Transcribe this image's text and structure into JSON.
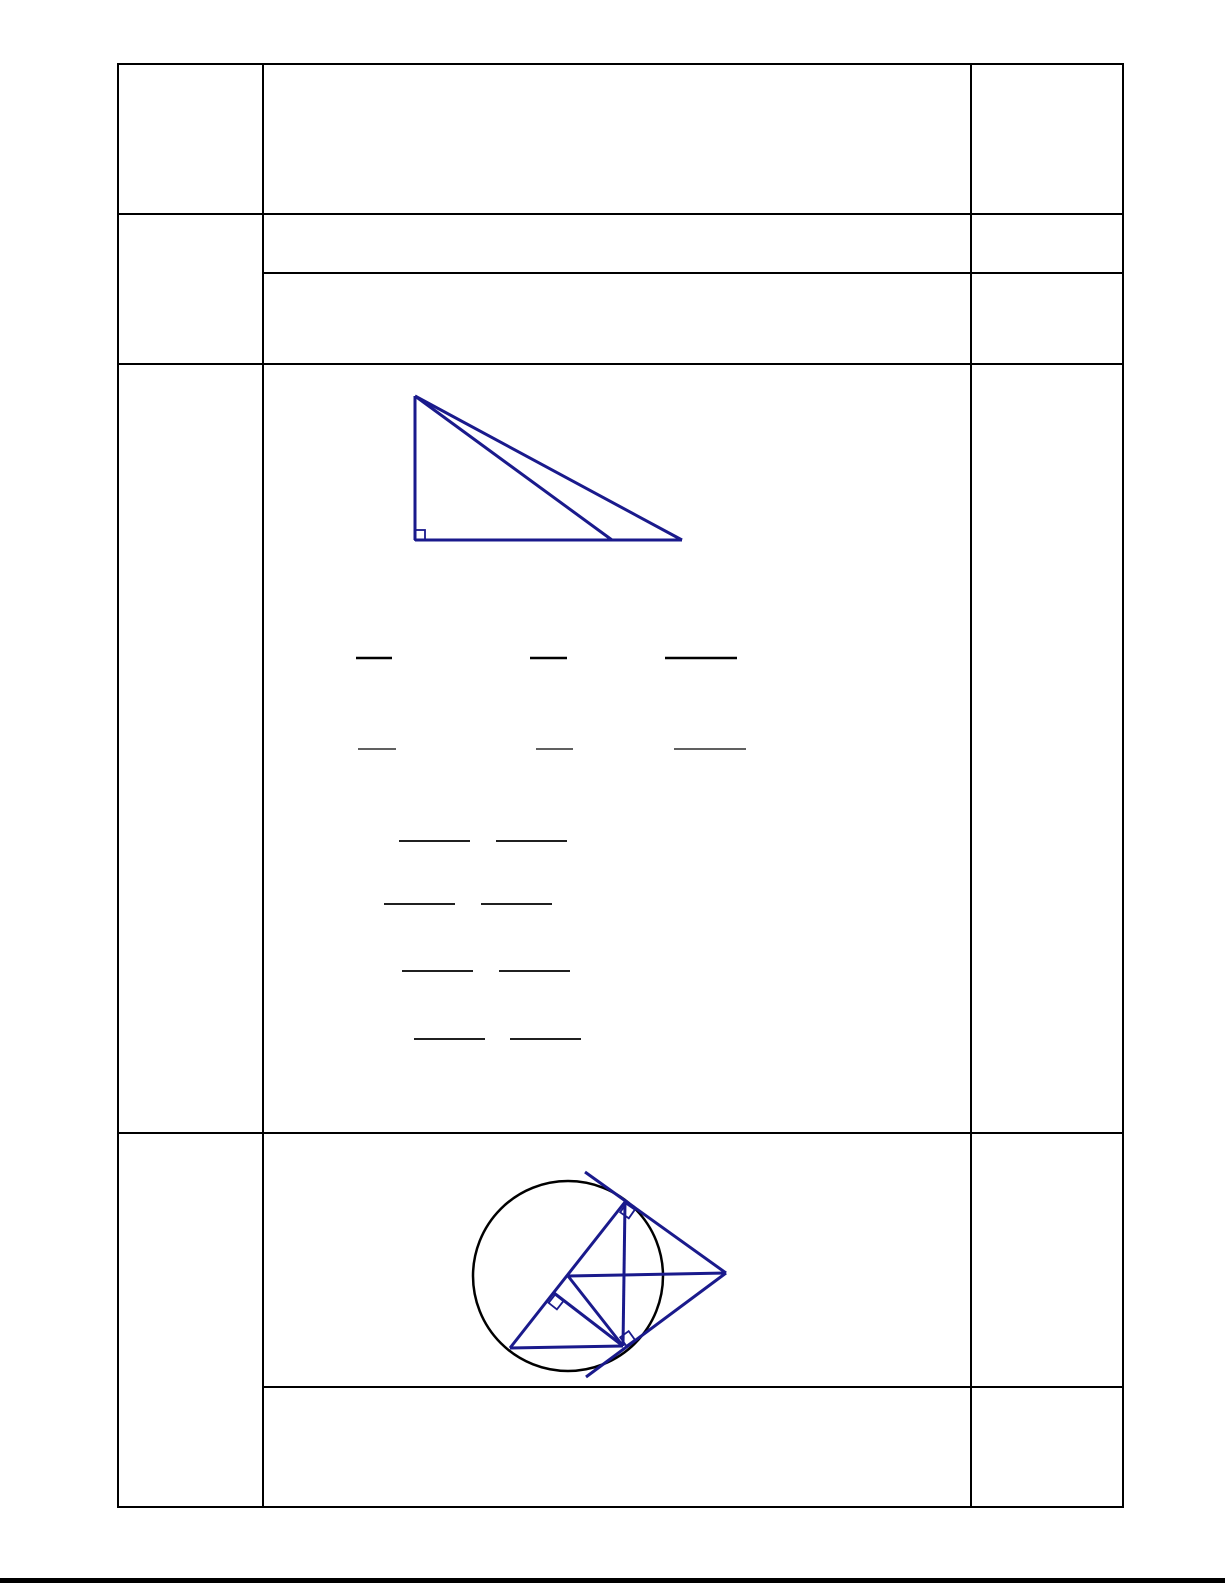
{
  "page": {
    "background": "#ffffff",
    "footer_bar_color": "#000000"
  },
  "table": {
    "border_color": "#000000",
    "rows": 4,
    "columns": 3,
    "note_visible_text": ""
  },
  "figures": {
    "stroke_color": "#1a1a8c",
    "stroke_width": 3,
    "marker_stroke_width": 1.8,
    "right_triangle": {
      "description": "right triangle: vertical leg, horizontal base, hypotenuse and cevian from apex, right-angle marker at bottom-left corner",
      "segments": [
        [
          415,
          396,
          415,
          540
        ],
        [
          415,
          540,
          682,
          540
        ],
        [
          415,
          396,
          682,
          540
        ],
        [
          415,
          396,
          612,
          540
        ]
      ],
      "markers": [
        {
          "cx": 420,
          "cy": 535,
          "size": 10,
          "rotate": 0
        }
      ]
    },
    "circle_figure": {
      "description": "circle with two tangents from external right point, tangent-point chord, diameter, inscribed triangle, radius and perpendicular foot segment, three right-angle markers",
      "circle": {
        "cx": 568,
        "cy": 1276,
        "r": 95,
        "stroke": "#000000",
        "stroke_width": 2.5
      },
      "segments": [
        [
          585,
          1172,
          726,
          1273
        ],
        [
          586,
          1377,
          726,
          1273
        ],
        [
          625,
          1202,
          623,
          1346
        ],
        [
          625,
          1202,
          510,
          1348
        ],
        [
          510,
          1348,
          623,
          1346
        ],
        [
          568,
          1276,
          726,
          1273
        ],
        [
          568,
          1276,
          623,
          1346
        ],
        [
          554,
          1293,
          623,
          1346
        ]
      ],
      "markers": [
        {
          "cx": 627.5,
          "cy": 1211,
          "size": 10.5,
          "rotate": 35
        },
        {
          "cx": 627.5,
          "cy": 1338.5,
          "size": 10.5,
          "rotate": -36
        },
        {
          "cx": 556,
          "cy": 1302,
          "size": 10.5,
          "rotate": 38
        }
      ]
    },
    "blank_lines": {
      "color": "#000000",
      "rows": [
        {
          "y": 658,
          "thickness": 2.4,
          "segments": [
            [
              356,
              392
            ],
            [
              530,
              567
            ],
            [
              665,
              737
            ]
          ]
        },
        {
          "y": 749,
          "thickness": 1.2,
          "segments": [
            [
              358,
              396
            ],
            [
              536,
              573
            ],
            [
              674,
              746
            ]
          ]
        },
        {
          "y": 841,
          "thickness": 1.8,
          "segments": [
            [
              399,
              470
            ],
            [
              496,
              567
            ]
          ]
        },
        {
          "y": 904,
          "thickness": 1.8,
          "segments": [
            [
              384,
              455
            ],
            [
              481,
              552
            ]
          ]
        },
        {
          "y": 971,
          "thickness": 1.8,
          "segments": [
            [
              402,
              473
            ],
            [
              499,
              570
            ]
          ]
        },
        {
          "y": 1039,
          "thickness": 1.8,
          "segments": [
            [
              414,
              485
            ],
            [
              510,
              581
            ]
          ]
        }
      ]
    }
  }
}
